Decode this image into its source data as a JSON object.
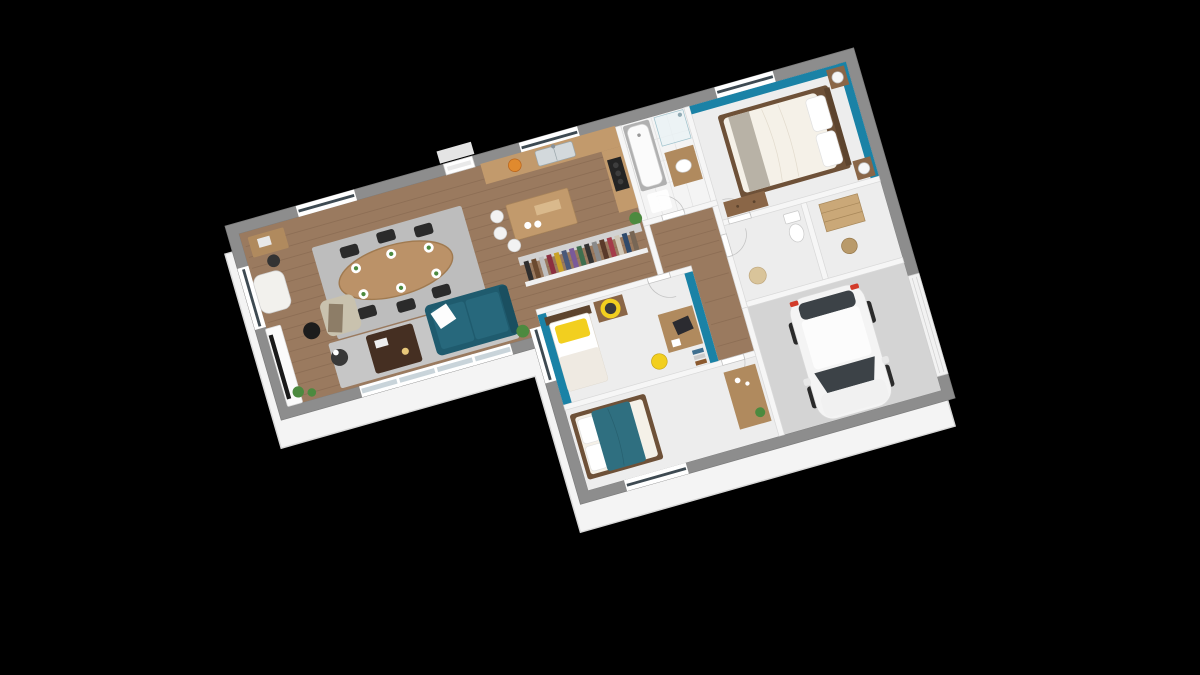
{
  "scene": {
    "type": "3d-floorplan-render",
    "description": "Isometric 3D render of an L-shaped single-storey house floor plan on a black background, rotated about 16-19 degrees",
    "background": "#000000"
  },
  "palette": {
    "background": "#000000",
    "wall_face": "#f4f4f4",
    "exterior_wall": "#8d8d8d",
    "interior_wall": "#f6f6f6",
    "accent_teal": "#1a82a6",
    "wood_floor": "#9a7a5f",
    "light_floor": "#ededed",
    "tile_floor": "#f4f4f4",
    "garage_floor": "#d4d4d4",
    "rug": "#bdbdbd",
    "counter_wood": "#c29a6c",
    "furniture_wood": "#8a6647",
    "desk_wood": "#b08a5e",
    "dark_wood": "#452f22",
    "headboard_wood": "#5d442e",
    "bed_frame_wood": "#6e5138",
    "sofa_teal": "#1f5b6e",
    "duvet_teal": "#2f6f80",
    "accent_yellow": "#f2cf1f",
    "chair_dark": "#2b2b2b",
    "bedding_white": "#f5f1e8",
    "bath_tile": "#b0b0b0",
    "steel": "#d3d9dc",
    "glass_dark": "#3e4a52",
    "car_body": "#f4f4f4",
    "car_glass": "#3c4247",
    "tail_red": "#d23b2a",
    "plant_green": "#4c8a3f",
    "white": "#ffffff"
  },
  "rooms": [
    {
      "id": "living-dining",
      "floor": "wood"
    },
    {
      "id": "kitchen",
      "floor": "wood"
    },
    {
      "id": "dressing-closet",
      "floor": "wood"
    },
    {
      "id": "bathroom",
      "floor": "tile"
    },
    {
      "id": "master-bedroom",
      "floor": "light",
      "accent_walls": "teal"
    },
    {
      "id": "hallway",
      "floor": "wood"
    },
    {
      "id": "wc",
      "floor": "light"
    },
    {
      "id": "storage",
      "floor": "light"
    },
    {
      "id": "kids-bedroom",
      "floor": "light",
      "accent_walls": "teal"
    },
    {
      "id": "bedroom-3",
      "floor": "light"
    },
    {
      "id": "garage",
      "floor": "concrete"
    }
  ],
  "furniture": {
    "living_dining": [
      "oval-dining-table",
      "six-black-chairs",
      "place-settings-with-green-napkins",
      "gray-rugs",
      "corner-desk",
      "desk-chair",
      "white-armchair",
      "tv-console",
      "tv",
      "black-floor-lamp",
      "beige-armchair-with-throw",
      "round-side-table",
      "dark-coffee-table",
      "teal-sofa-white-pillow",
      "potted-plants",
      "bay-window",
      "french-door"
    ],
    "kitchen": [
      "wall-counter",
      "double-sink",
      "fruit-bowl",
      "cooktop",
      "island",
      "three-white-bar-stools",
      "plant"
    ],
    "dressing": [
      "wardrobe-row",
      "hanging-clothes"
    ],
    "bathroom": [
      "bathtub",
      "glass-shower",
      "wood-vanity-with-basin",
      "bath-mat"
    ],
    "master_bedroom": [
      "double-bed-white-duvet",
      "two-pillows",
      "two-nightstands",
      "two-white-lamps",
      "dresser",
      "window"
    ],
    "wc_storage": [
      "toilet",
      "pet-basket",
      "shelving-unit",
      "wicker-basket"
    ],
    "kids_bedroom": [
      "single-bed",
      "yellow-pillow",
      "small-dresser",
      "round-yellow-mirror",
      "desk-with-laptop",
      "yellow-chair",
      "book-stack",
      "window"
    ],
    "bedroom_3": [
      "double-bed-teal-duvet",
      "white-pillows",
      "wood-console",
      "plant",
      "window"
    ],
    "garage": [
      "white-car",
      "garage-door"
    ]
  }
}
